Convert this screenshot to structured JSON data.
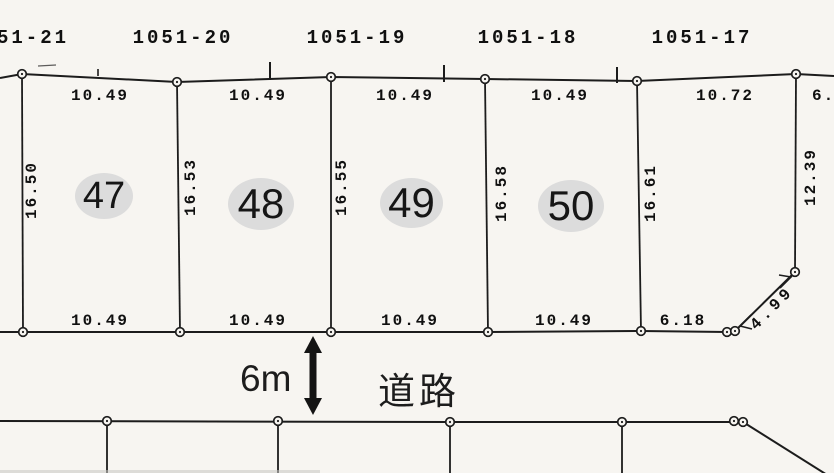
{
  "upper_lots": {
    "labels": [
      "51-21",
      "1051-20",
      "1051-19",
      "1051-18",
      "1051-17"
    ]
  },
  "plots": [
    {
      "number": "47",
      "dims": {
        "top": "10.49",
        "bottom": "10.49",
        "left": "16.50"
      }
    },
    {
      "number": "48",
      "dims": {
        "top": "10.49",
        "bottom": "10.49",
        "left": "16.53"
      }
    },
    {
      "number": "49",
      "dims": {
        "top": "10.49",
        "bottom": "10.49",
        "left": "16.55"
      }
    },
    {
      "number": "50",
      "dims": {
        "top": "10.49",
        "bottom": "10.49",
        "left": "16.58"
      }
    }
  ],
  "corner_lot": {
    "dims": {
      "top": "10.72",
      "bottom": "6.18",
      "left": "16.61",
      "right": "12.39",
      "diagonal": "4.99"
    }
  },
  "partial_dims": {
    "top_right": "6."
  },
  "road": {
    "name": "道路",
    "width_label": "6m"
  },
  "colors": {
    "line": "#1c1c1c",
    "text": "#101010",
    "plot_ellipse": "#dcdcdc",
    "background": "#f7f5f1"
  }
}
